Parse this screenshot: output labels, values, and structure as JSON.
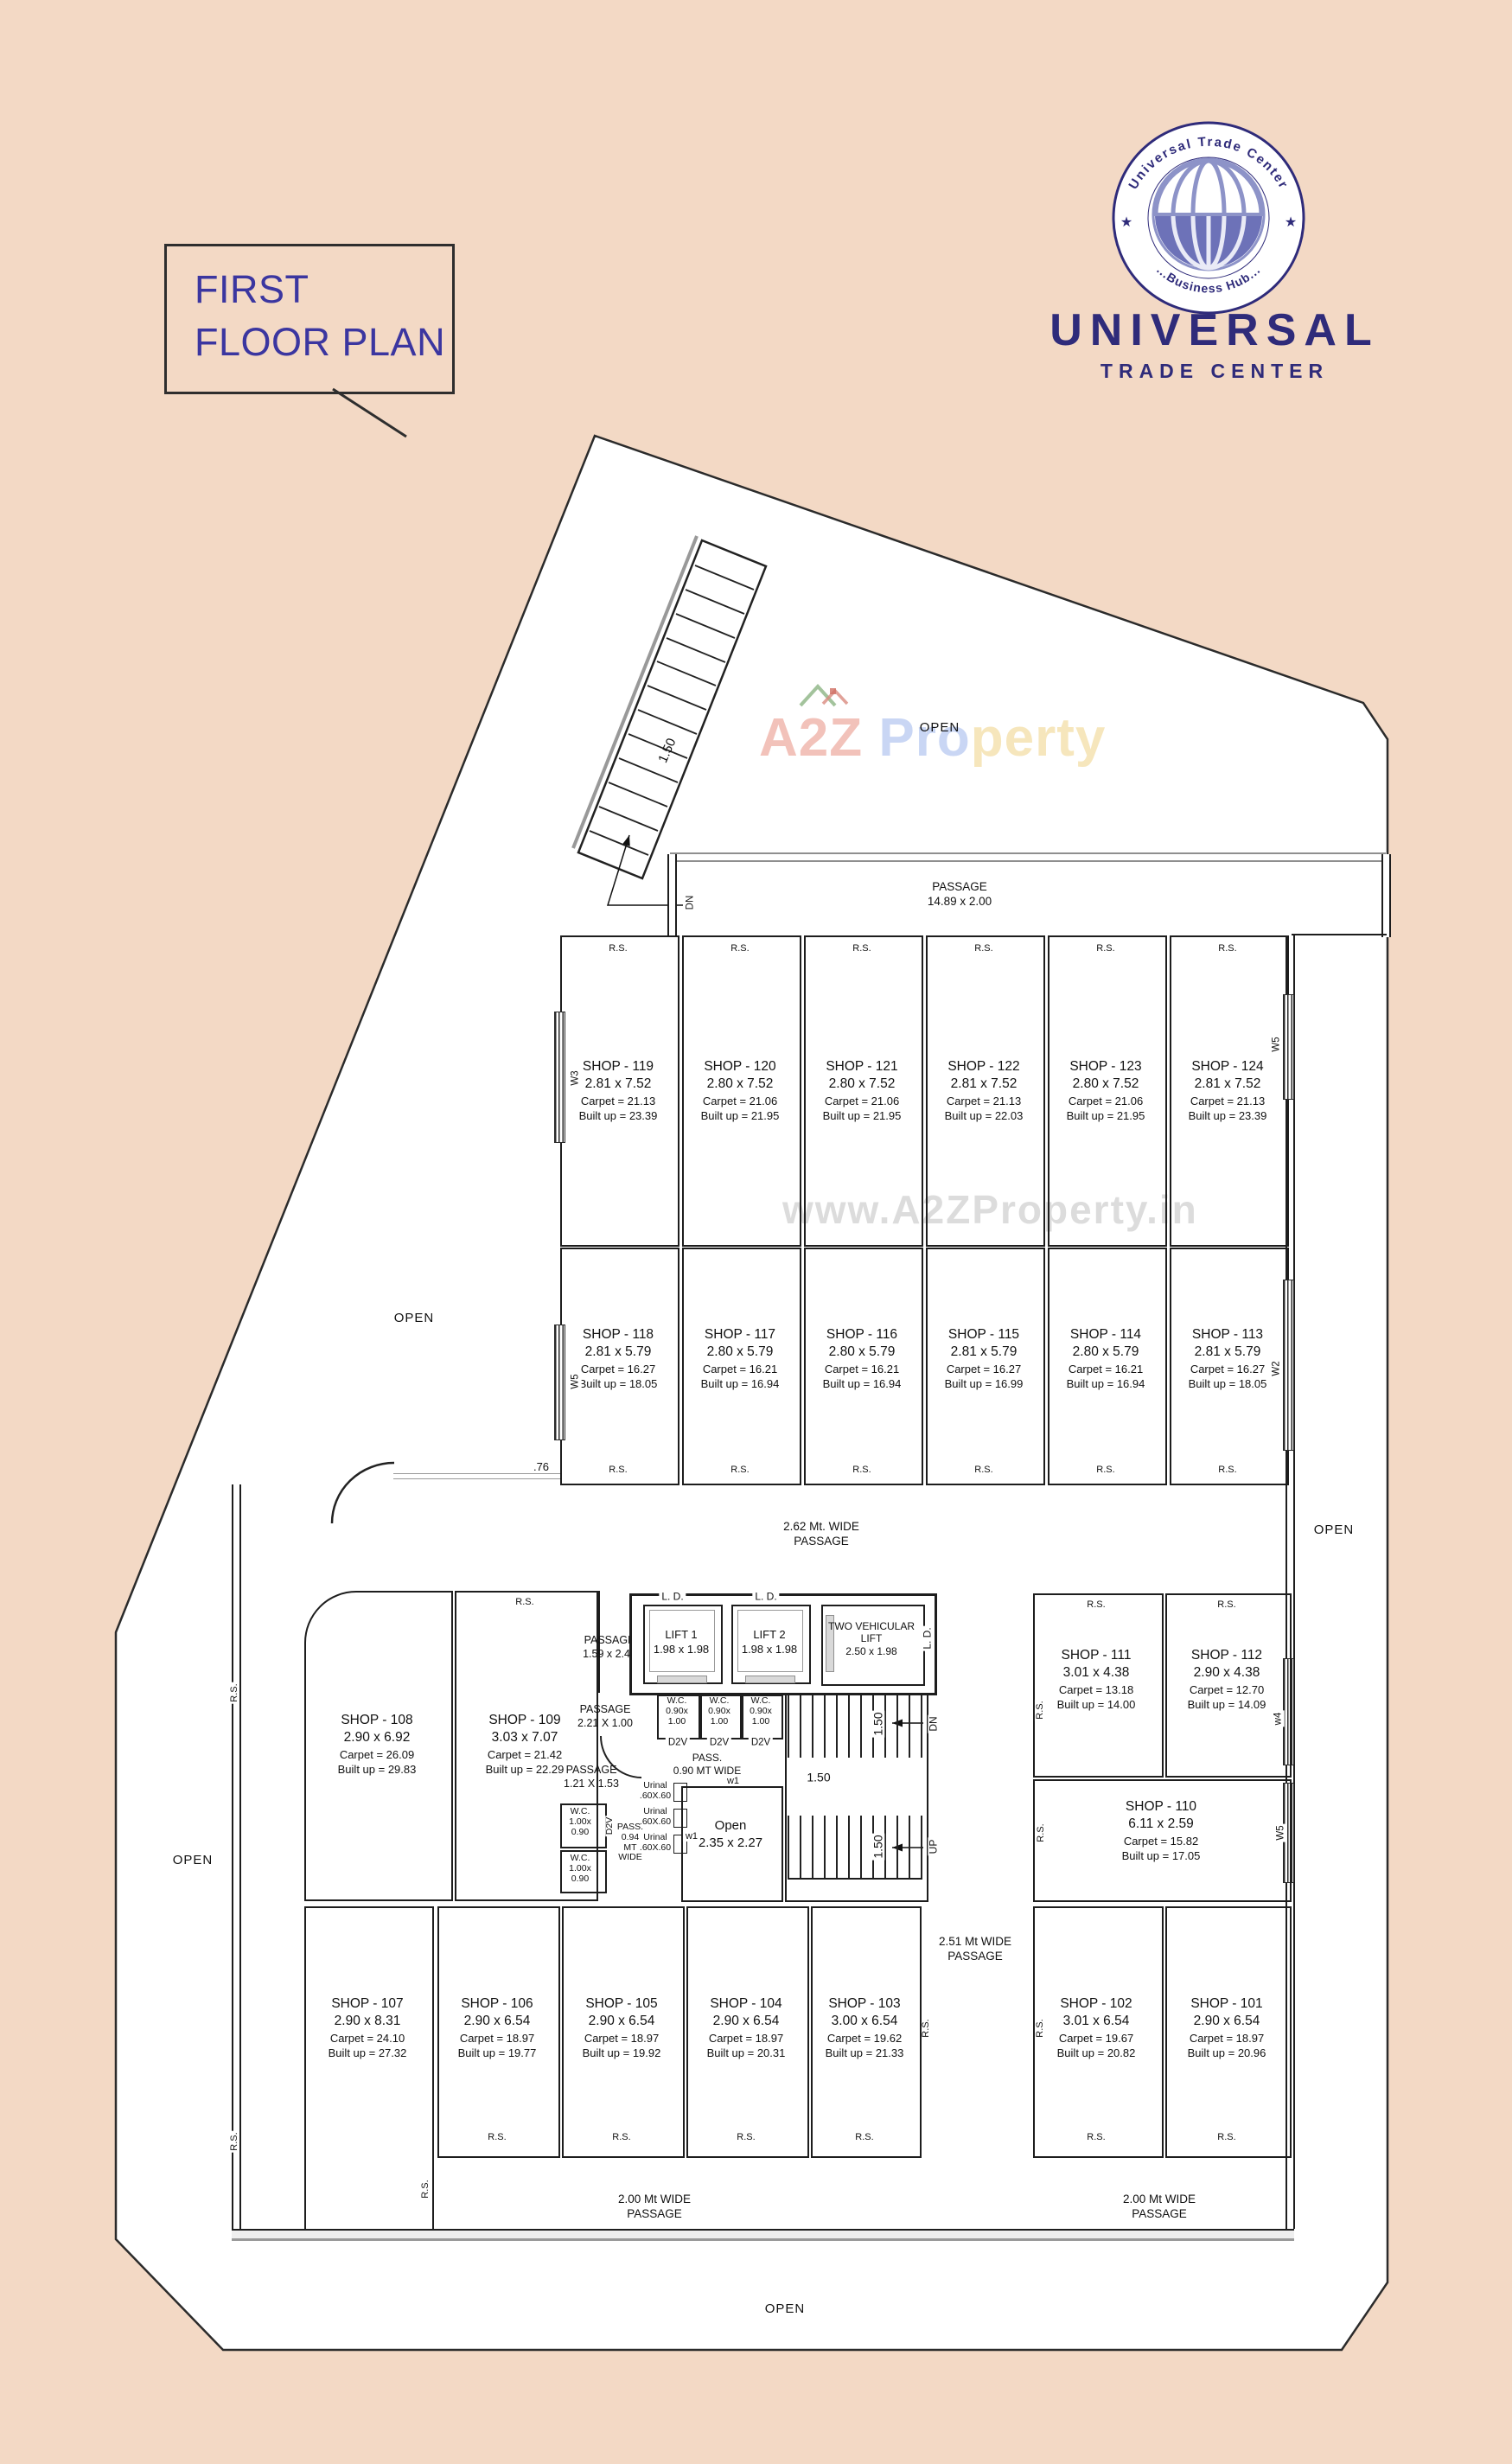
{
  "title_block": {
    "line1": "FIRST",
    "line2": "FLOOR PLAN"
  },
  "logo": {
    "arc_top": "Universal Trade Center",
    "arc_bottom": "...Business Hub...",
    "star": "★",
    "name": "UNIVERSAL",
    "subtitle": "TRADE CENTER"
  },
  "watermark": {
    "hero_a2z": "A2Z",
    "hero_pro": "Pro",
    "hero_perty": "perty",
    "center": "www.A2ZProperty.in"
  },
  "labels": {
    "open": "OPEN",
    "rs": "R.S.",
    "dn": "DN",
    "up": "UP",
    "ld": "L. D.",
    "d2v": "D2V",
    "dim150": "1.50",
    "dim076": ".76"
  },
  "windows": {
    "w1": "w1",
    "w2": "W2",
    "w3": "W3",
    "w4": "w4",
    "w5": "W5"
  },
  "passages": {
    "top": {
      "l1": "PASSAGE",
      "l2": "14.89 x 2.00"
    },
    "p262": {
      "l1": "2.62 Mt. WIDE",
      "l2": "PASSAGE"
    },
    "p159": {
      "l1": "PASSAGE",
      "l2": "1.59 x 2.44"
    },
    "p221": {
      "l1": "PASSAGE",
      "l2": "2.21 X 1.00"
    },
    "p121": {
      "l1": "PASSAGE",
      "l2": "1.21 X 1.53"
    },
    "p090": {
      "l1": "PASS.",
      "l2": "0.90 MT WIDE"
    },
    "p094": {
      "l1": "PASS.",
      "l2": "0.94",
      "l3": "MT",
      "l4": "WIDE"
    },
    "p251": {
      "l1": "2.51 Mt WIDE",
      "l2": "PASSAGE"
    },
    "p200": {
      "l1": "2.00 Mt WIDE",
      "l2": "PASSAGE"
    }
  },
  "rooms": {
    "lift1": {
      "l1": "LIFT 1",
      "l2": "1.98 x 1.98"
    },
    "lift2": {
      "l1": "LIFT 2",
      "l2": "1.98 x 1.98"
    },
    "vlift": {
      "l1": "TWO VEHICULAR",
      "l2": "LIFT",
      "l3": "2.50 x 1.98"
    },
    "wc_small": {
      "l1": "W.C.",
      "l2": "0.90x",
      "l3": "1.00"
    },
    "wc_left": {
      "l1": "W.C.",
      "l2": "1.00x",
      "l3": "0.90"
    },
    "urinal": {
      "l1": "Urinal",
      "l2": ".60X.60"
    },
    "open_room": {
      "l1": "Open",
      "l2": "2.35 x 2.27"
    }
  },
  "shops": {
    "s119": {
      "name": "SHOP - 119",
      "dim": "2.81 x 7.52",
      "carpet": "Carpet = 21.13",
      "built": "Built up = 23.39"
    },
    "s120": {
      "name": "SHOP - 120",
      "dim": "2.80 x 7.52",
      "carpet": "Carpet = 21.06",
      "built": "Built up = 21.95"
    },
    "s121": {
      "name": "SHOP - 121",
      "dim": "2.80 x 7.52",
      "carpet": "Carpet = 21.06",
      "built": "Built up = 21.95"
    },
    "s122": {
      "name": "SHOP - 122",
      "dim": "2.81 x 7.52",
      "carpet": "Carpet = 21.13",
      "built": "Built up = 22.03"
    },
    "s123": {
      "name": "SHOP - 123",
      "dim": "2.80 x 7.52",
      "carpet": "Carpet = 21.06",
      "built": "Built up = 21.95"
    },
    "s124": {
      "name": "SHOP - 124",
      "dim": "2.81 x 7.52",
      "carpet": "Carpet = 21.13",
      "built": "Built up = 23.39"
    },
    "s118": {
      "name": "SHOP - 118",
      "dim": "2.81 x 5.79",
      "carpet": "Carpet = 16.27",
      "built": "Built up = 18.05"
    },
    "s117": {
      "name": "SHOP - 117",
      "dim": "2.80 x 5.79",
      "carpet": "Carpet = 16.21",
      "built": "Built up = 16.94"
    },
    "s116": {
      "name": "SHOP - 116",
      "dim": "2.80 x 5.79",
      "carpet": "Carpet = 16.21",
      "built": "Built up = 16.94"
    },
    "s115": {
      "name": "SHOP - 115",
      "dim": "2.81 x 5.79",
      "carpet": "Carpet = 16.27",
      "built": "Built up = 16.99"
    },
    "s114": {
      "name": "SHOP - 114",
      "dim": "2.80 x 5.79",
      "carpet": "Carpet = 16.21",
      "built": "Built up = 16.94"
    },
    "s113": {
      "name": "SHOP - 113",
      "dim": "2.81 x 5.79",
      "carpet": "Carpet = 16.27",
      "built": "Built up = 18.05"
    },
    "s108": {
      "name": "SHOP - 108",
      "dim": "2.90 x 6.92",
      "carpet": "Carpet = 26.09",
      "built": "Built up = 29.83"
    },
    "s109": {
      "name": "SHOP - 109",
      "dim": "3.03 x 7.07",
      "carpet": "Carpet = 21.42",
      "built": "Built up = 22.29"
    },
    "s111": {
      "name": "SHOP - 111",
      "dim": "3.01 x 4.38",
      "carpet": "Carpet = 13.18",
      "built": "Built up = 14.00"
    },
    "s112": {
      "name": "SHOP - 112",
      "dim": "2.90 x 4.38",
      "carpet": "Carpet = 12.70",
      "built": "Built up = 14.09"
    },
    "s110": {
      "name": "SHOP - 110",
      "dim": "6.11 x 2.59",
      "carpet": "Carpet = 15.82",
      "built": "Built up = 17.05"
    },
    "s107": {
      "name": "SHOP - 107",
      "dim": "2.90 x 8.31",
      "carpet": "Carpet = 24.10",
      "built": "Built up = 27.32"
    },
    "s106": {
      "name": "SHOP - 106",
      "dim": "2.90 x 6.54",
      "carpet": "Carpet = 18.97",
      "built": "Built up = 19.77"
    },
    "s105": {
      "name": "SHOP - 105",
      "dim": "2.90 x 6.54",
      "carpet": "Carpet = 18.97",
      "built": "Built up = 19.92"
    },
    "s104": {
      "name": "SHOP - 104",
      "dim": "2.90 x 6.54",
      "carpet": "Carpet = 18.97",
      "built": "Built up = 20.31"
    },
    "s103": {
      "name": "SHOP - 103",
      "dim": "3.00 x 6.54",
      "carpet": "Carpet = 19.62",
      "built": "Built up = 21.33"
    },
    "s102": {
      "name": "SHOP - 102",
      "dim": "3.01 x 6.54",
      "carpet": "Carpet = 19.67",
      "built": "Built up = 20.82"
    },
    "s101": {
      "name": "SHOP - 101",
      "dim": "2.90 x 6.54",
      "carpet": "Carpet = 18.97",
      "built": "Built up = 20.96"
    }
  },
  "colors": {
    "background": "#f3d9c5",
    "brand": "#2f2b7a",
    "title": "#3b36a0",
    "line": "#1d1d1d",
    "glazing": "#8f8f8f",
    "watermark": "#d7d7d7"
  }
}
